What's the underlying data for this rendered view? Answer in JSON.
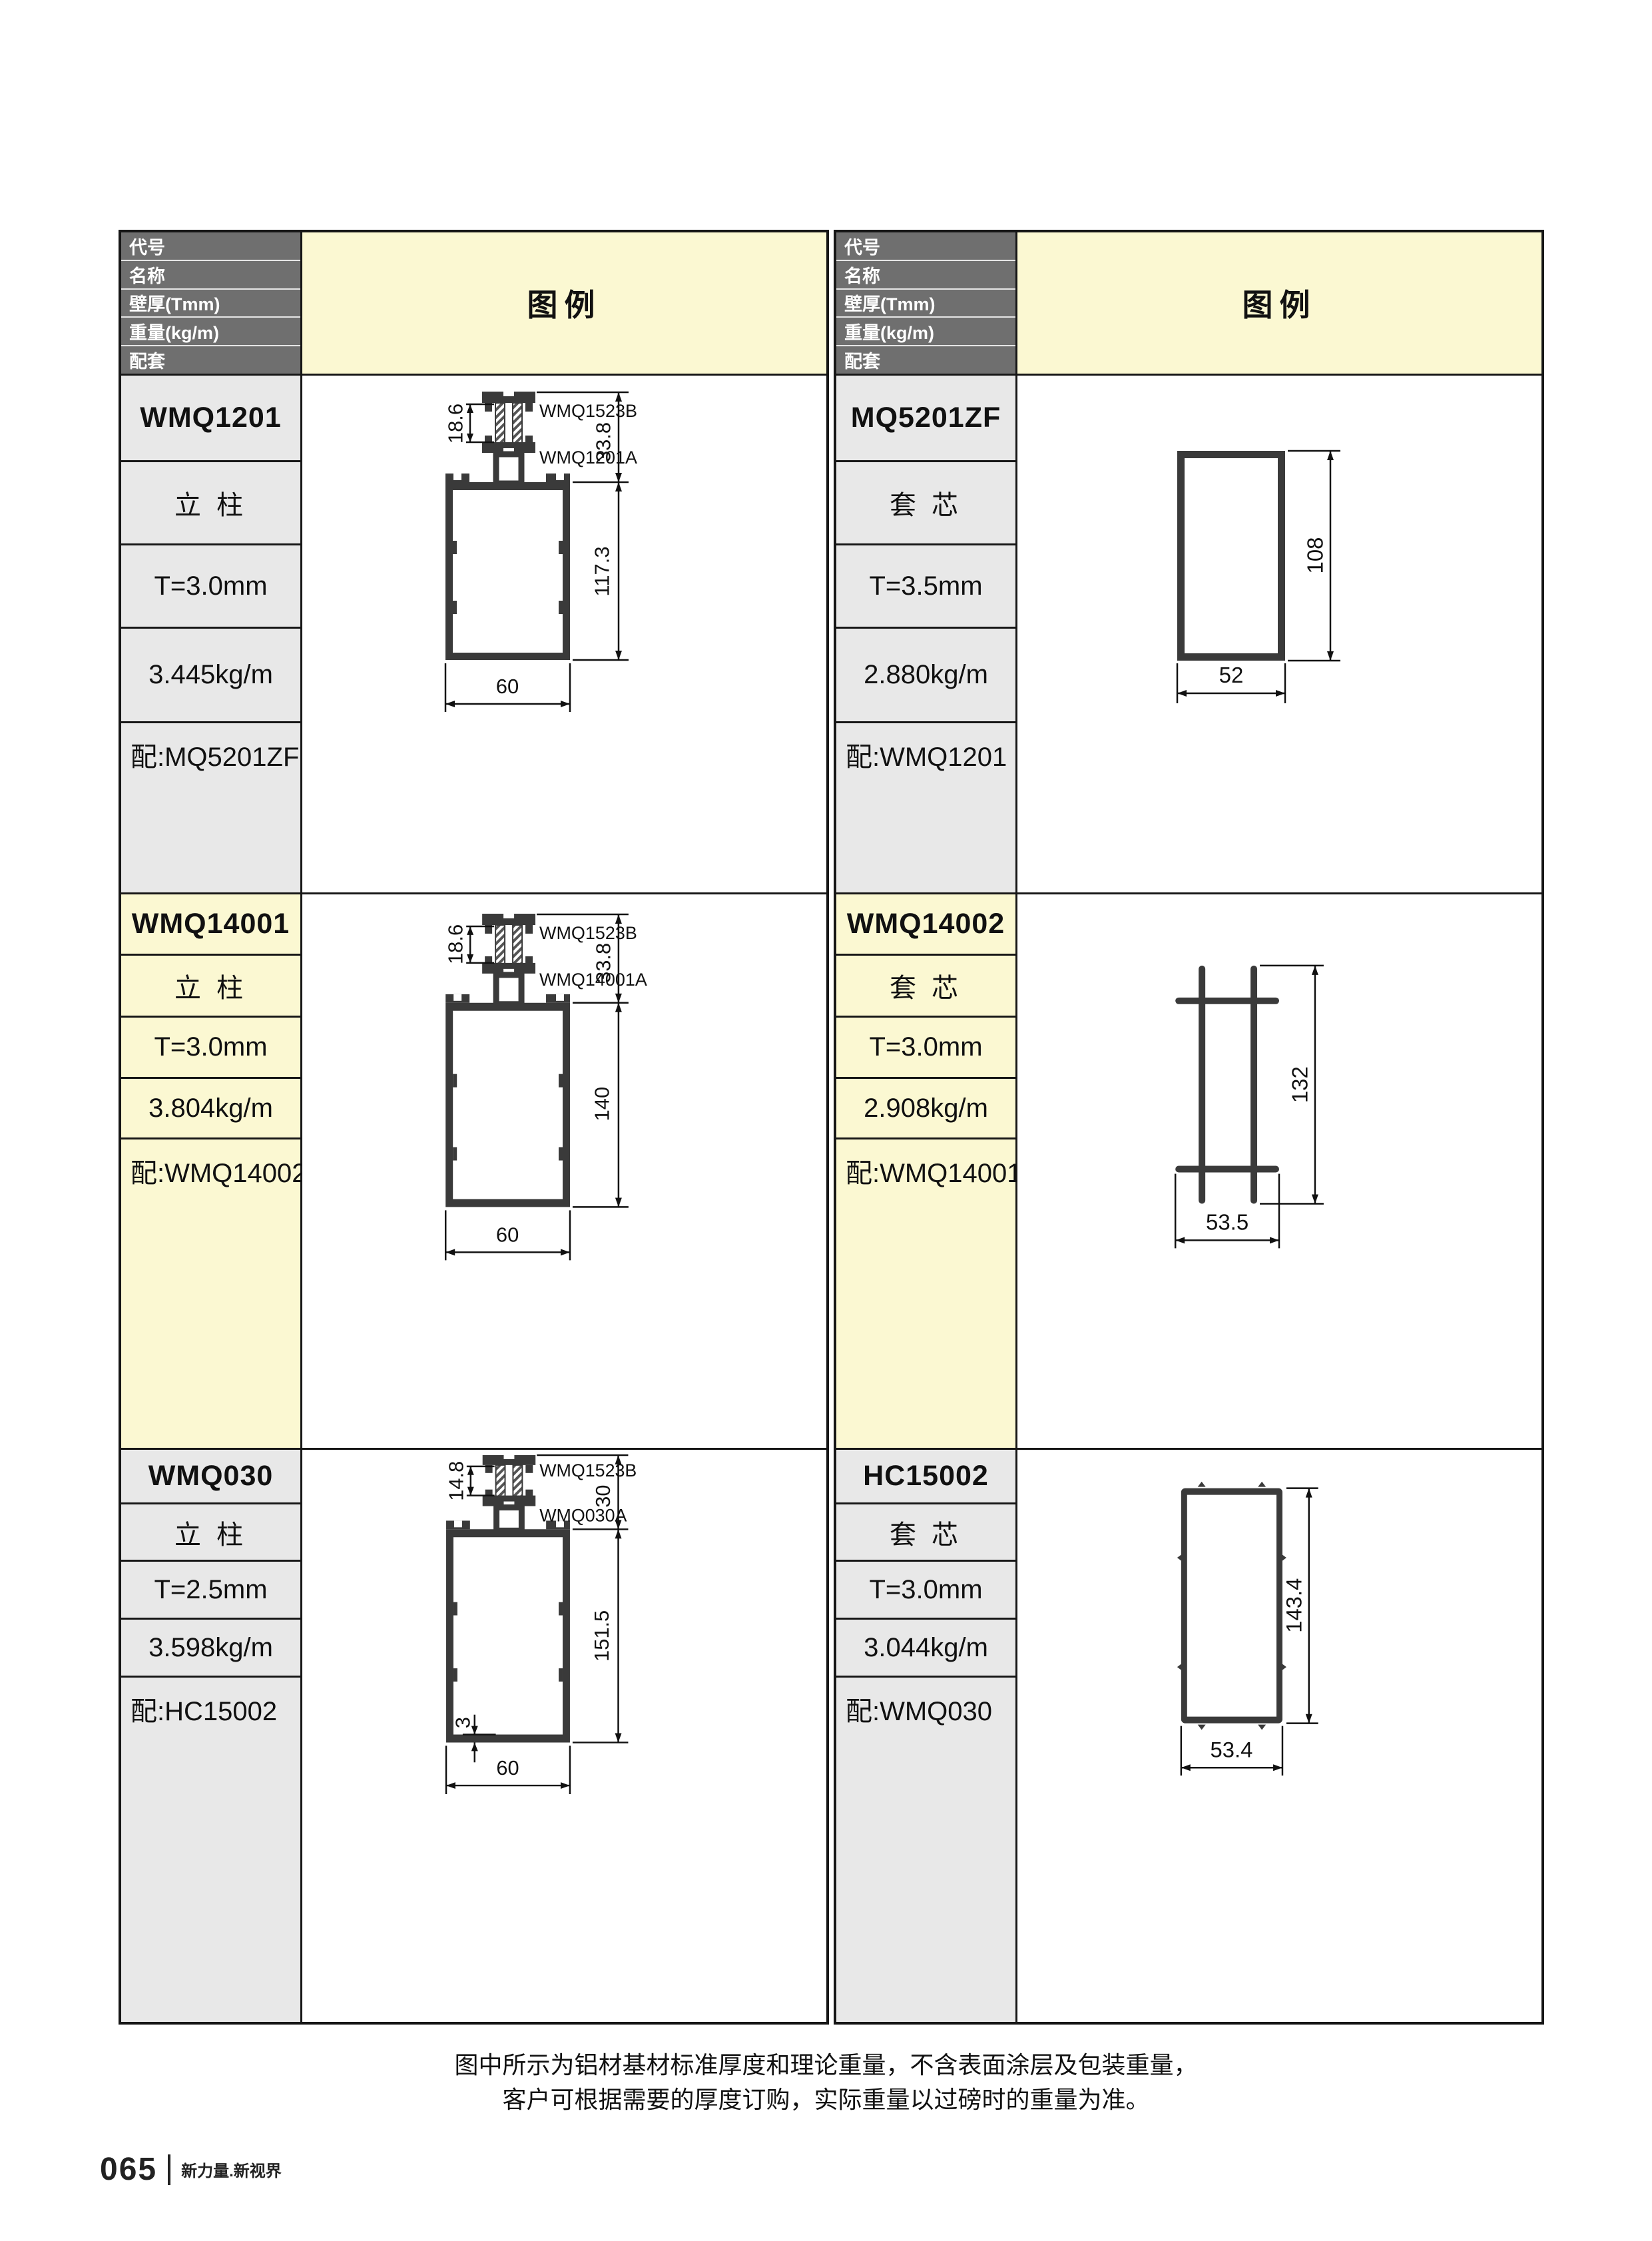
{
  "header": {
    "row_labels": [
      "代号",
      "名称",
      "壁厚(Tmm)",
      "重量(kg/m)",
      "配套"
    ],
    "legend_label": "图例"
  },
  "entries": [
    {
      "code": "WMQ1201",
      "name": "立 柱",
      "thickness": "T=3.0mm",
      "weight": "3.445kg/m",
      "match": "配:MQ5201ZF",
      "drawing": {
        "part_top_label": "WMQ1523B",
        "part_body_label": "WMQ1201A",
        "dim_insert": "18.6",
        "dim_head": "33.8",
        "dim_height": "117.3",
        "dim_width": "60"
      }
    },
    {
      "code": "MQ5201ZF",
      "name": "套 芯",
      "thickness": "T=3.5mm",
      "weight": "2.880kg/m",
      "match": "配:WMQ1201",
      "drawing": {
        "dim_height": "108",
        "dim_width": "52"
      }
    },
    {
      "code": "WMQ14001",
      "name": "立 柱",
      "thickness": "T=3.0mm",
      "weight": "3.804kg/m",
      "match": "配:WMQ14002",
      "drawing": {
        "part_top_label": "WMQ1523B",
        "part_body_label": "WMQ14001A",
        "dim_insert": "18.6",
        "dim_head": "33.8",
        "dim_height": "140",
        "dim_width": "60"
      }
    },
    {
      "code": "WMQ14002",
      "name": "套 芯",
      "thickness": "T=3.0mm",
      "weight": "2.908kg/m",
      "match": "配:WMQ14001",
      "drawing": {
        "dim_height": "132",
        "dim_width": "53.5"
      }
    },
    {
      "code": "WMQ030",
      "name": "立 柱",
      "thickness": "T=2.5mm",
      "weight": "3.598kg/m",
      "match": "配:HC15002",
      "drawing": {
        "part_top_label": "WMQ1523B",
        "part_body_label": "WMQ030A",
        "dim_insert": "14.8",
        "dim_head": "30",
        "dim_height": "151.5",
        "dim_width": "60",
        "dim_wall": "3"
      }
    },
    {
      "code": "HC15002",
      "name": "套 芯",
      "thickness": "T=3.0mm",
      "weight": "3.044kg/m",
      "match": "配:WMQ030",
      "drawing": {
        "dim_height": "143.4",
        "dim_width": "53.4"
      }
    }
  ],
  "notes": [
    "图中所示为铝材基材标准厚度和理论重量，不含表面涂层及包装重量，",
    "客户可根据需要的厚度订购，实际重量以过磅时的重量为准。"
  ],
  "footer": {
    "page_number": "065",
    "slogan": "新力量.新视界"
  },
  "colors": {
    "header_bg": "#6f6f6f",
    "pale_yellow": "#FBF8D2",
    "cell_gray": "#E8E8E8",
    "line_black": "#161616"
  }
}
